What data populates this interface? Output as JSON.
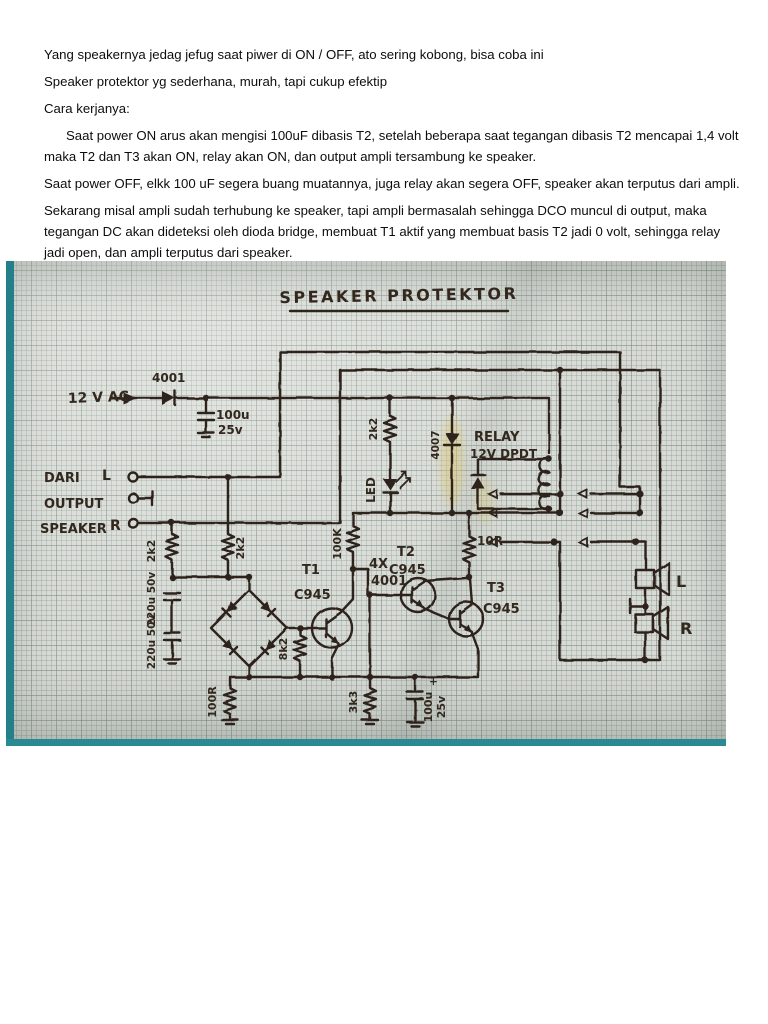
{
  "document": {
    "paragraphs": [
      "Yang speakernya jedag jefug saat piwer di ON / OFF, ato sering kobong, bisa coba ini",
      "Speaker protektor yg sederhana, murah, tapi cukup efektip",
      "Cara kerjanya:",
      "Saat power ON arus akan mengisi 100uF dibasis T2, setelah beberapa saat tegangan dibasis T2 mencapai 1,4 volt maka T2 dan T3 akan ON, relay akan ON, dan output ampli tersambung ke speaker.",
      "Saat power OFF, elkk 100 uF segera buang muatannya, juga relay akan segera OFF, speaker akan terputus dari ampli.",
      "Sekarang misal ampli sudah terhubung ke speaker, tapi ampli bermasalah sehingga DCO muncul di output, maka tegangan DC akan dideteksi oleh dioda bridge, membuat T1 aktif yang membuat basis T2 jadi 0 volt, sehingga relay jadi open, dan ampli terputus dari speaker."
    ]
  },
  "schematic": {
    "title": "SPEAKER PROTEKTOR",
    "labels": {
      "supply": "12 V AC",
      "d1": "4001",
      "c1_value": "100u",
      "c1_volt": "25v",
      "src1": "DARI",
      "src2": "OUTPUT",
      "src3": "SPEAKER",
      "in_l": "L",
      "in_r": "R",
      "r_in_left": "2k2",
      "r_in_right": "2k2",
      "c_in_top": "220u 50v",
      "c_in_bottom": "220u 50v",
      "bridge1": "4X",
      "bridge2": "4001",
      "t1": "T1",
      "t1_type": "C945",
      "r_t1": "8k2",
      "r_100k": "100K",
      "r_led": "2k2",
      "led": "LED",
      "d2": "4007",
      "relay1": "RELAY",
      "relay2": "12V DPDT",
      "t2": "T2",
      "t2_type": "C945",
      "t3": "T3",
      "t3_type": "C945",
      "r_10": "10R",
      "r_100": "100R",
      "r_3k3": "3k3",
      "c_out_plus": "+",
      "c_out_value": "100u",
      "c_out_volt": "25v",
      "spk_l": "L",
      "spk_r": "R"
    }
  }
}
